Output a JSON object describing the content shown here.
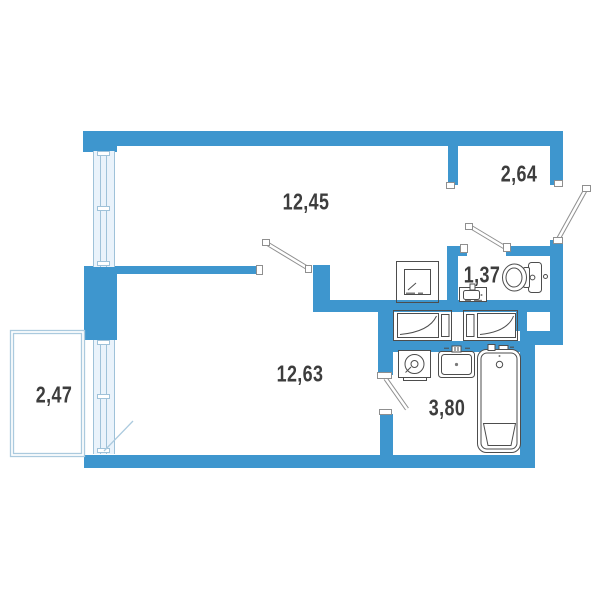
{
  "plan": {
    "type": "apartment-floor-plan",
    "colors": {
      "background": "#ffffff",
      "wall": "#3e96ce",
      "window_fill": "#eaf3fb",
      "window_line": "#9fc2d9",
      "balcony_line": "#abcade",
      "fixture_line": "#4d4d4d",
      "door_leaf": "#8f8f8f",
      "label_text": "#3d3d3d"
    },
    "rooms": [
      {
        "name": "living-room",
        "area_label": "12,45"
      },
      {
        "name": "entrance-hall",
        "area_label": "2,64"
      },
      {
        "name": "wc",
        "area_label": "1,37"
      },
      {
        "name": "bedroom",
        "area_label": "12,63"
      },
      {
        "name": "bathroom",
        "area_label": "3,80"
      },
      {
        "name": "balcony",
        "area_label": "2,47"
      }
    ],
    "fixtures": [
      {
        "name": "stove-symbol"
      },
      {
        "name": "toilet-symbol"
      },
      {
        "name": "wc-sink-symbol"
      },
      {
        "name": "wardrobe-symbol-left"
      },
      {
        "name": "wardrobe-symbol-right"
      },
      {
        "name": "washing-machine-symbol"
      },
      {
        "name": "bathroom-sink-symbol"
      },
      {
        "name": "bathtub-symbol"
      }
    ],
    "doors": [
      {
        "name": "entrance-door"
      },
      {
        "name": "wc-door"
      },
      {
        "name": "room-door"
      },
      {
        "name": "bathroom-door"
      },
      {
        "name": "balcony-door"
      }
    ]
  }
}
